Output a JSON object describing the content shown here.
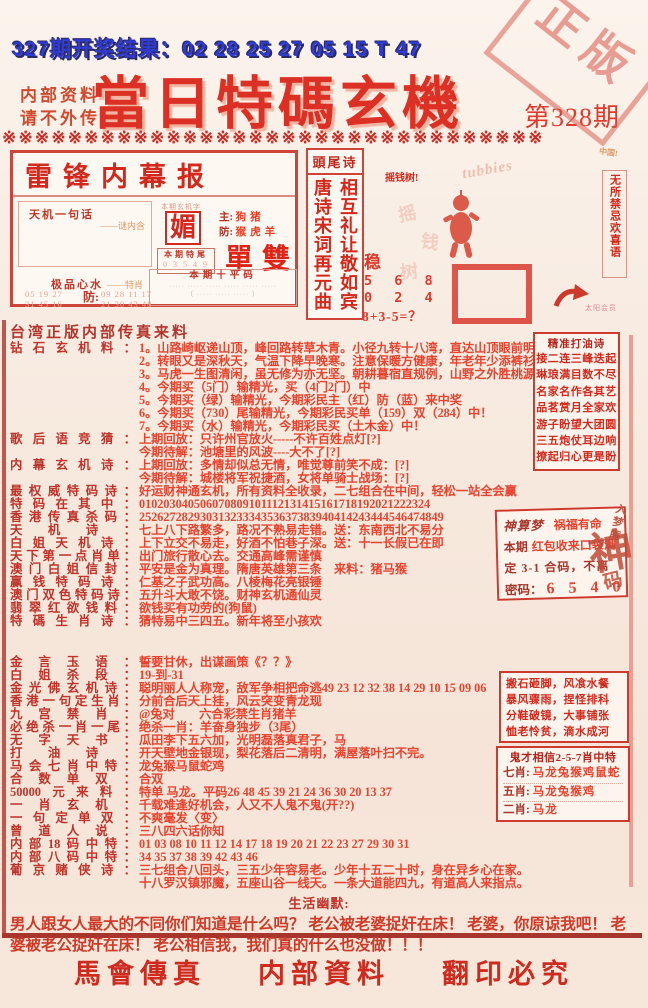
{
  "page": {
    "result_line": "327期开奖结果：02 28 25 27 05 15 T 47",
    "confidential": "内部资料\n请不外传",
    "title": "當日特碼玄機",
    "issue": "第328期",
    "stamp": "正版",
    "divider": "※※※※※※※※※※※※※※※※※※※※※※※※※※※※※※※※※"
  },
  "leifeng": {
    "title": "雷锋内幕报",
    "tianji_label": "天机一句话",
    "tianji_note": "——谜内含",
    "charbox_header": "本期玄机字",
    "mystery_char": "媚",
    "zhu_label": "主:",
    "zhu_value": "狗猪",
    "fang_label": "防:",
    "fang_value": "猴虎羊",
    "danshuang": "單雙",
    "tewei_label": "本期特尾",
    "tewei_digits": "0 3 5 4 9",
    "xinshui_label": "极品心水",
    "xinshui_note": "——特肖",
    "xinshui_left": "05 19 27\n31 45 16",
    "xinshui_fang": "防:",
    "xinshui_right": "09 28 11 17\n21 30 43 48",
    "pingma_label": "本期十平码",
    "pingma_f1": "····· ····· ····· ····· ····· ·····",
    "pingma_f2": "（ ····· ····· ····· ）"
  },
  "poem_box": {
    "header": "頭尾诗",
    "col_right": "相互礼让敬如宾",
    "col_left": "唐诗宋词再元曲"
  },
  "center_art": {
    "money_tree": "摇钱树!",
    "brand": "tubbies",
    "wen": "稳",
    "row1": "5 6 8",
    "row2": "0 2 4",
    "formula": "8+3-5=？",
    "china": "中国!",
    "vertical_text": "无所禁忌欢喜语",
    "member": "太阳会员"
  },
  "main": {
    "source": "台湾正版内部传真来料",
    "lines": [
      {
        "label": "钻石玄机料：",
        "text": "1。山路崎岖递山顶，峰回路转草木青。小径九转十八湾，直达山顶眼前明。（森）"
      },
      {
        "label": "",
        "text": "2。转眼又是深秋天，气温下降早晚寒。注意保暖方健康，年老年少添裤衫。（啥）"
      },
      {
        "label": "",
        "text": "3。马虎一生图清闲，虽无修为亦无坚。朝耕暮宿直规例，山野之外胜桃源。（鼠）"
      },
      {
        "label": "",
        "text": "4。今期买（5门）输精光，买（4门2门）中"
      },
      {
        "label": "",
        "text": "5。今期买（绿）输精光，今期彩民主（红）防（蓝）来中奖"
      },
      {
        "label": "",
        "text": "6。今期买（730）尾输精光，今期彩民买单（159）双（284）中！"
      },
      {
        "label": "",
        "text": "7。今期买（水）输精光，今期彩民买（土木金）中！"
      },
      {
        "label": "歌后语竞猜：",
        "text": "上期回放：只许州官放火-----不许百姓点灯[?]"
      },
      {
        "label": "",
        "text": "今期待解：池塘里的风波----大不了[?]"
      },
      {
        "label": "内幕玄机诗：",
        "text": "上期回放：多情却似总无情，唯觉尊前笑不成：[?]"
      },
      {
        "label": "",
        "text": "今期待解：城楼将军祝捷酒，女将单骑士战场：[?]"
      },
      {
        "label": "最权威特码诗：",
        "text": "好运财神通玄机，所有资料全收录，二七组合在中间，轻松一站全会赢"
      },
      {
        "label": "特码在其中：",
        "text": "010203040506070809101112131415161718192021222324"
      },
      {
        "label": "香港传真杀码：",
        "text": "25262728293031323334353637383940414243444546474849"
      },
      {
        "label": "天机诗：",
        "text": "七上八下路繁多，路况不熟易走错。送：东南西北不易分"
      },
      {
        "label": "白姐天机诗：",
        "text": "上下立交不易走，好酒不怕巷子深。送：十一长假已在即"
      },
      {
        "label": "天下第一点肖单：",
        "text": "出门旅行散心去。交通高峰需谨慎"
      },
      {
        "label": "澳门白姐信封：",
        "text": "平安是金为真理。隋唐英雄第三条　来料：猪马猴"
      },
      {
        "label": "赢钱特码诗：",
        "text": "仁基之子武功高。八棱梅花亮银锤"
      },
      {
        "label": "澳门双色特码诗：",
        "text": "五升斗大敢不饶。财神玄机通仙灵"
      },
      {
        "label": "翡翠红欲钱料：",
        "text": "欲钱买有功劳的(狗鼠)"
      },
      {
        "label": "特碼生肖诗：",
        "text": "猜特易中三四五。新年将至小孩欢"
      },
      {
        "label": "金言玉语：",
        "text": "誓要甘休，出谋画策《？？》",
        "gap": 28
      },
      {
        "label": "白姐杀段：",
        "text": "19-到-31"
      },
      {
        "label": "金光佛玄机诗：",
        "text": "聪明丽人人称宠，敌军争相把命逃49 23 12 32 38 14 29 10 15 09 06"
      },
      {
        "label": "香港一句定生肖：",
        "text": "分前合后天上挂，风云突变青龙现"
      },
      {
        "label": "九宫禁肖：",
        "text": "@兔对　　六合彩禁生肖猪羊"
      },
      {
        "label": "必绝杀一肖一尾：",
        "text": "绝杀一肖：羊奋身独步（3尾）"
      },
      {
        "label": "无字天书：",
        "text": "瓜田李下五六加，光明磊落真君子，马"
      },
      {
        "label": "打油诗：",
        "text": "开天壁地金银现，梨花落后二清明，满屋落叶扫不完。"
      },
      {
        "label": "马会七肖中特：",
        "text": "龙兔猴马鼠蛇鸡"
      },
      {
        "label": "合数单双：",
        "text": "合双"
      },
      {
        "label": "50000元来料：",
        "text": "特单 马龙。平码26 48 45 39 21 24 36 30 20 13 37"
      },
      {
        "label": "一肖玄机：",
        "text": "千载难逢好机会，人又不人鬼不鬼(开??)"
      },
      {
        "label": "一句定单双：",
        "text": "不爽毫发〈变〉"
      },
      {
        "label": "曾道人说：",
        "text": "三八四六话你知"
      },
      {
        "label": "内部18码中特：",
        "text": "01 03 08 10 11 12 14 17 18 19 20 21 22 23 27 29 30 31"
      },
      {
        "label": "内部八码中特：",
        "text": "34 35 37 38 39 42 43 46"
      },
      {
        "label": "葡京赌侠诗：",
        "text": "三七组合八回头，三五少年容易老。少年十五二十时，身在异乡心在家。"
      },
      {
        "label": "",
        "text": "十八罗汉镇邪魔，五座山谷一线天。一条大道能四九，有道高人来指点。"
      }
    ]
  },
  "right_boxes": {
    "dayou": {
      "title": "精准打油诗",
      "lines": [
        "接二连三峰迭起",
        "琳琅满目数不尽",
        "名家名作各其艺",
        "品茗赏月全家欢",
        "游子盼望大团圆",
        "三五炮仗耳边响",
        "撩起归心更是盼"
      ]
    },
    "shensuan": {
      "t1": "神算梦",
      "t2": "祸福有命",
      "l2a": "本期",
      "l2b": "红包收来口袋满",
      "l3": "定 3-1 合码，不离",
      "l4a": "密码：",
      "l4b": "6 5 4 0",
      "seal_side": "入梦庵",
      "seal_big": "神",
      "seal_small": "码"
    },
    "idioms": {
      "lines": [
        "搬石砸脚，风飡水餐",
        "暴风骤雨，捏怪排科",
        "分鞋破镜，大事铺张",
        "恤老怜贫，滴水成河"
      ]
    },
    "guicai": {
      "title": "鬼才相信2-5-7肖中特",
      "rows": [
        {
          "label": "七肖:",
          "value": "马龙兔猴鸡鼠蛇"
        },
        {
          "label": "五肖:",
          "value": "马龙兔猴鸡"
        },
        {
          "label": "二肖:",
          "value": "马龙"
        }
      ]
    }
  },
  "humor": {
    "title": "生活幽默:",
    "text": "男人跟女人最大的不同你们知道是什么吗？ 老公被老婆捉奸在床！ 老婆，你原谅我吧！ 老婆被老公捉奸在床！ 老公相信我，我们真的什么也没做！！！"
  },
  "footer": {
    "items": [
      "馬會傳真",
      "内部資料",
      "翻印必究"
    ]
  }
}
